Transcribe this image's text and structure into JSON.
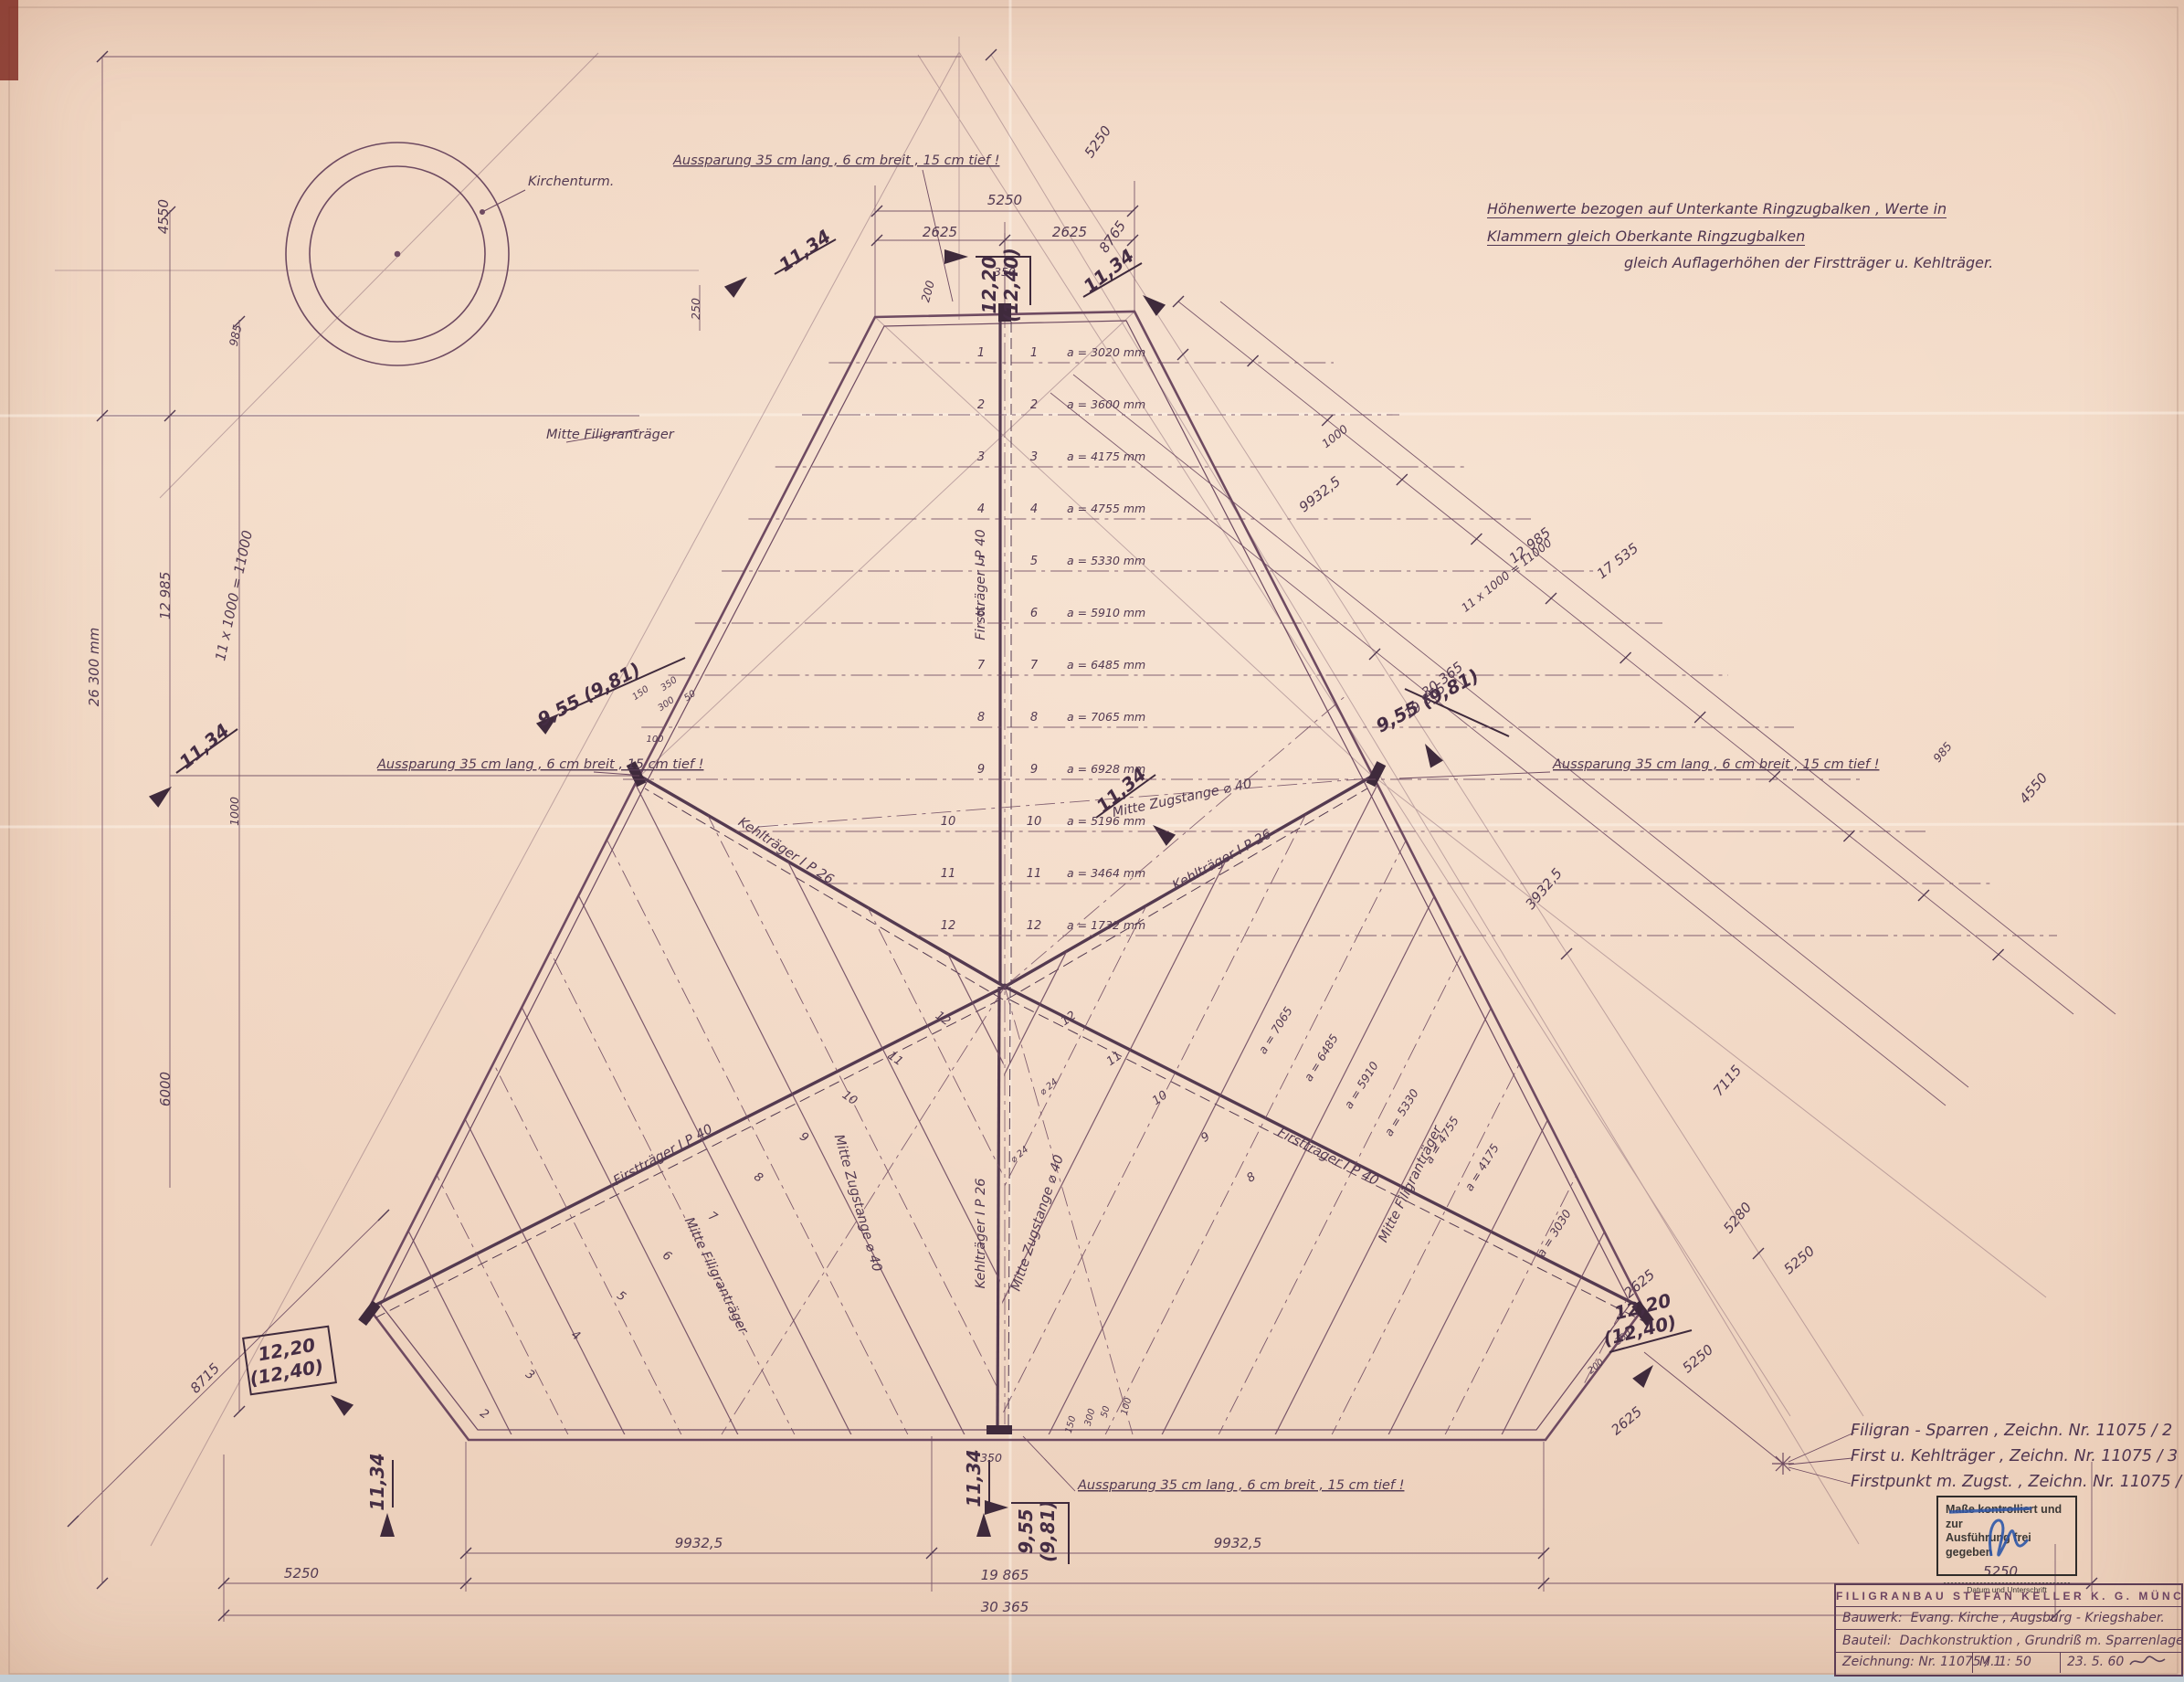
{
  "colors": {
    "paper": "#f0d5c1",
    "ink": "#63415a",
    "ink_dark": "#3f2a3c",
    "text": "#533a52",
    "stamp_blue": "#2e56a8"
  },
  "header_note": {
    "line1": "Höhenwerte  bezogen  auf  Unterkante  Ringzugbalken ,  Werte  in  Klammern  gleich  Oberkante  Ringzugbalken",
    "line2": "gleich  Auflagerhöhen  der  Firstträger  u. Kehlträger."
  },
  "drawing_refs": [
    "Filigran - Sparren  ,   Zeichn. Nr. 11075 / 2",
    "First u. Kehlträger  ,   Zeichn. Nr. 11075 / 3",
    "Firstpunkt  m. Zugst. ,   Zeichn. Nr. 11075 / 4"
  ],
  "stamp": {
    "line1": "Maße kontrolliert und zur",
    "line2": "Ausführung frei gegeben",
    "caption": "Datum und Unterschrift"
  },
  "title_block": {
    "company": "FILIGRANBAU  STEFAN  KELLER  K. G.  MÜNCHEN",
    "bauwerk_label": "Bauwerk:",
    "bauwerk": "Evang. Kirche , Augsburg - Kriegshaber.",
    "bauteil_label": "Bauteil:",
    "bauteil": "Dachkonstruktion , Grundriß m. Sparrenlage , Ausspar.",
    "zeichnung": "Zeichnung:  Nr. 11075 / 1",
    "massstab": "M.  1: 50",
    "datum": "23. 5. 60"
  },
  "rows": [
    {
      "n": "1",
      "a": "a = 3020 mm"
    },
    {
      "n": "2",
      "a": "a = 3600 mm"
    },
    {
      "n": "3",
      "a": "a = 4175 mm"
    },
    {
      "n": "4",
      "a": "a = 4755 mm"
    },
    {
      "n": "5",
      "a": "a = 5330 mm"
    },
    {
      "n": "6",
      "a": "a = 5910 mm"
    },
    {
      "n": "7",
      "a": "a = 6485 mm"
    },
    {
      "n": "8",
      "a": "a = 7065 mm"
    },
    {
      "n": "9",
      "a": "a = 6928 mm"
    },
    {
      "n": "10",
      "a": "a = 5196 mm"
    },
    {
      "n": "11",
      "a": "a = 3464 mm"
    },
    {
      "n": "12",
      "a": "a = 1732 mm"
    }
  ],
  "annotations": [
    [
      "Aussparung  35 cm lang ,  6 cm breit ,  15 cm tief !",
      737,
      180,
      0,
      "lab",
      "s",
      1
    ],
    [
      "5250",
      1100,
      224,
      0,
      "dimL",
      "m",
      0
    ],
    [
      "2625",
      1029,
      259,
      0,
      "dimL",
      "m",
      0
    ],
    [
      "2625",
      1171,
      259,
      0,
      "dimL",
      "m",
      0
    ],
    [
      "350",
      1100,
      302,
      0,
      "dim",
      "m",
      0
    ],
    [
      "200",
      1020,
      320,
      -75,
      "dim",
      "m",
      0
    ],
    [
      "250",
      766,
      338,
      -90,
      "dim",
      "m",
      0
    ],
    [
      "12,20",
      1090,
      312,
      -90,
      "big",
      "m",
      0
    ],
    [
      "(12,40)",
      1114,
      312,
      -90,
      "big",
      "m",
      0
    ],
    [
      "11,34",
      885,
      280,
      -35,
      "big",
      "m",
      0
    ],
    [
      "11,34",
      1218,
      302,
      -38,
      "big",
      "m",
      0
    ],
    [
      "8765",
      1222,
      262,
      -55,
      "dimL",
      "m",
      0
    ],
    [
      "5250",
      1206,
      158,
      -55,
      "dimL",
      "m",
      0
    ],
    [
      "Kirchenturm.",
      578,
      203,
      0,
      "lab",
      "s",
      0
    ],
    [
      "4550",
      184,
      237,
      -90,
      "dimL",
      "m",
      0
    ],
    [
      "985",
      262,
      368,
      -78,
      "dim",
      "m",
      0
    ],
    [
      "12 985",
      186,
      652,
      -90,
      "dimL",
      "m",
      0
    ],
    [
      "26 300 mm",
      108,
      730,
      -90,
      "dimL",
      "m",
      0
    ],
    [
      "11 x 1000 = 11000",
      261,
      653,
      -78,
      "dimL",
      "m",
      0
    ],
    [
      "1000",
      261,
      888,
      -90,
      "dim",
      "m",
      0
    ],
    [
      "6000",
      186,
      1192,
      -90,
      "dimL",
      "m",
      0
    ],
    [
      "8715",
      228,
      1512,
      -46,
      "dimL",
      "m",
      0
    ],
    [
      "11,34",
      228,
      822,
      -40,
      "big",
      "m",
      0
    ],
    [
      "9,55 (9,81)",
      648,
      766,
      -28,
      "big",
      "m",
      0
    ],
    [
      "Aussparung  35 cm lang ,  6 cm breit ,  15 cm tief !",
      413,
      841,
      0,
      "lab",
      "s",
      1
    ],
    [
      "150",
      703,
      761,
      -35,
      "tiny",
      "m",
      0
    ],
    [
      "350",
      734,
      751,
      -35,
      "tiny",
      "m",
      0
    ],
    [
      "300",
      731,
      773,
      -35,
      "tiny",
      "m",
      0
    ],
    [
      "50",
      757,
      764,
      -35,
      "tiny",
      "m",
      0
    ],
    [
      "100",
      717,
      812,
      0,
      "tiny",
      "m",
      0
    ],
    [
      "Mitte Filigranträger",
      598,
      480,
      0,
      "lab",
      "s",
      0
    ],
    [
      "Firstträger  I P 40",
      1078,
      640,
      -90,
      "lab",
      "m",
      0
    ],
    [
      "Mitte Zugstange  ⌀ 40",
      1295,
      878,
      -12,
      "lab",
      "m",
      0
    ],
    [
      "Kehlträger  I P 26",
      858,
      935,
      33,
      "lab",
      "m",
      0
    ],
    [
      "Kehlträger  I P 26",
      1340,
      945,
      -29,
      "lab",
      "m",
      0
    ],
    [
      "Mitte Zugstange  ⌀ 40",
      935,
      1318,
      74,
      "lab",
      "m",
      0
    ],
    [
      "Mitte Zugstange  ⌀ 40",
      1140,
      1340,
      -72,
      "lab",
      "m",
      0
    ],
    [
      "Kehlträger  I P 26",
      1078,
      1350,
      -90,
      "lab",
      "m",
      0
    ],
    [
      "Firstträger  I P 40",
      728,
      1268,
      -29,
      "lab",
      "m",
      0
    ],
    [
      "Firstträger  I P 40",
      1452,
      1270,
      27,
      "lab",
      "m",
      0
    ],
    [
      "Mitte Filigranträger",
      780,
      1398,
      64,
      "lab",
      "m",
      0
    ],
    [
      "Mitte Filigranträger",
      1548,
      1298,
      -64,
      "lab",
      "m",
      0
    ],
    [
      "⌀ 24",
      1150,
      1192,
      -40,
      "tiny",
      "m",
      0
    ],
    [
      "⌀ 24",
      1118,
      1266,
      -40,
      "tiny",
      "m",
      0
    ],
    [
      "9,55 (9,81)",
      1566,
      773,
      -28,
      "big",
      "m",
      0
    ],
    [
      "Aussparung  35 cm lang ,  6 cm breit ,  15 cm tief !",
      1700,
      841,
      0,
      "lab",
      "s",
      1
    ],
    [
      "11,34",
      1232,
      870,
      -40,
      "big",
      "m",
      0
    ],
    [
      "1000",
      1464,
      481,
      -38,
      "dim",
      "m",
      0
    ],
    [
      "9932,5",
      1448,
      545,
      -38,
      "dimL",
      "m",
      0
    ],
    [
      "12 985",
      1678,
      601,
      -38,
      "dimL",
      "m",
      0
    ],
    [
      "17 535",
      1774,
      618,
      -38,
      "dimL",
      "m",
      0
    ],
    [
      "11 x 1000 = 11000",
      1652,
      633,
      -38,
      "dim",
      "m",
      0
    ],
    [
      "30 365",
      1582,
      748,
      -38,
      "dimL",
      "m",
      0
    ],
    [
      "19 865",
      1563,
      771,
      -38,
      "dimL",
      "m",
      0
    ],
    [
      "3932,5",
      1694,
      976,
      -50,
      "dimL",
      "m",
      0
    ],
    [
      "7115",
      1895,
      1186,
      -50,
      "dimL",
      "m",
      0
    ],
    [
      "5280",
      1906,
      1336,
      -50,
      "dimL",
      "m",
      0
    ],
    [
      "5250",
      1973,
      1383,
      -40,
      "dimL",
      "m",
      0
    ],
    [
      "2625",
      1798,
      1409,
      -40,
      "dimL",
      "m",
      0
    ],
    [
      "5250",
      1862,
      1491,
      -40,
      "dimL",
      "m",
      0
    ],
    [
      "2625",
      1784,
      1559,
      -40,
      "dimL",
      "m",
      0
    ],
    [
      "350",
      1779,
      1466,
      -40,
      "tiny",
      "m",
      0
    ],
    [
      "200",
      1749,
      1498,
      -40,
      "tiny",
      "m",
      0
    ],
    [
      "985",
      2130,
      826,
      -50,
      "dim",
      "m",
      0
    ],
    [
      "4550",
      2230,
      866,
      -50,
      "dimL",
      "m",
      0
    ],
    [
      "12,20",
      1800,
      1437,
      -14,
      "big",
      "m",
      0
    ],
    [
      "(12,40)",
      1797,
      1463,
      -14,
      "big",
      "m",
      0
    ],
    [
      "11,34",
      1073,
      1618,
      -90,
      "big",
      "m",
      0
    ],
    [
      "11,34",
      420,
      1622,
      -90,
      "big",
      "m",
      0
    ],
    [
      "9,55",
      1130,
      1676,
      -90,
      "big",
      "m",
      0
    ],
    [
      "(9,81)",
      1154,
      1676,
      -90,
      "big",
      "m",
      0
    ],
    [
      "12,20",
      315,
      1484,
      -10,
      "big",
      "m",
      0
    ],
    [
      "(12,40)",
      315,
      1509,
      -10,
      "big",
      "m",
      0
    ],
    [
      "Aussparung  35 cm lang ,  6 cm breit ,  15 cm tief !",
      1180,
      1630,
      0,
      "lab",
      "s",
      1
    ],
    [
      "350",
      1085,
      1600,
      0,
      "dim",
      "m",
      0
    ],
    [
      "150",
      1175,
      1560,
      -75,
      "tiny",
      "m",
      0
    ],
    [
      "300",
      1196,
      1552,
      -75,
      "tiny",
      "m",
      0
    ],
    [
      "50",
      1213,
      1546,
      -75,
      "tiny",
      "m",
      0
    ],
    [
      "100",
      1236,
      1540,
      -75,
      "tiny",
      "m",
      0
    ],
    [
      "9932,5",
      765,
      1694,
      0,
      "dimL",
      "m",
      0
    ],
    [
      "9932,5",
      1355,
      1694,
      0,
      "dimL",
      "m",
      0
    ],
    [
      "5250",
      330,
      1727,
      0,
      "dimL",
      "m",
      0
    ],
    [
      "19 865",
      1100,
      1729,
      0,
      "dimL",
      "m",
      0
    ],
    [
      "5250",
      2190,
      1725,
      0,
      "dimL",
      "m",
      0
    ],
    [
      "30 365",
      1100,
      1764,
      0,
      "dimL",
      "m",
      0
    ],
    [
      "12",
      1030,
      1118,
      35,
      "num",
      "m",
      0
    ],
    [
      "11",
      978,
      1162,
      35,
      "num",
      "m",
      0
    ],
    [
      "10",
      928,
      1205,
      35,
      "num",
      "m",
      0
    ],
    [
      "9",
      878,
      1248,
      35,
      "num",
      "m",
      0
    ],
    [
      "8",
      828,
      1292,
      35,
      "num",
      "m",
      0
    ],
    [
      "7",
      778,
      1335,
      35,
      "num",
      "m",
      0
    ],
    [
      "6",
      728,
      1378,
      35,
      "num",
      "m",
      0
    ],
    [
      "5",
      678,
      1422,
      35,
      "num",
      "m",
      0
    ],
    [
      "4",
      628,
      1465,
      35,
      "num",
      "m",
      0
    ],
    [
      "3",
      578,
      1508,
      35,
      "num",
      "m",
      0
    ],
    [
      "2",
      528,
      1551,
      35,
      "num",
      "m",
      0
    ],
    [
      "12",
      1172,
      1118,
      -35,
      "num",
      "m",
      0
    ],
    [
      "11",
      1222,
      1162,
      -35,
      "num",
      "m",
      0
    ],
    [
      "10",
      1272,
      1205,
      -35,
      "num",
      "m",
      0
    ],
    [
      "9",
      1322,
      1248,
      -35,
      "num",
      "m",
      0
    ],
    [
      "8",
      1372,
      1292,
      -35,
      "num",
      "m",
      0
    ],
    [
      "a = 7065",
      1400,
      1130,
      -58,
      "dim",
      "m",
      0
    ],
    [
      "a = 6485",
      1450,
      1160,
      -58,
      "dim",
      "m",
      0
    ],
    [
      "a = 5910",
      1494,
      1190,
      -58,
      "dim",
      "m",
      0
    ],
    [
      "a = 5330",
      1538,
      1220,
      -58,
      "dim",
      "m",
      0
    ],
    [
      "a = 4755",
      1582,
      1250,
      -58,
      "dim",
      "m",
      0
    ],
    [
      "a = 4175",
      1626,
      1280,
      -58,
      "dim",
      "m",
      0
    ],
    [
      "a = 3030",
      1705,
      1352,
      -58,
      "dim",
      "m",
      0
    ]
  ]
}
